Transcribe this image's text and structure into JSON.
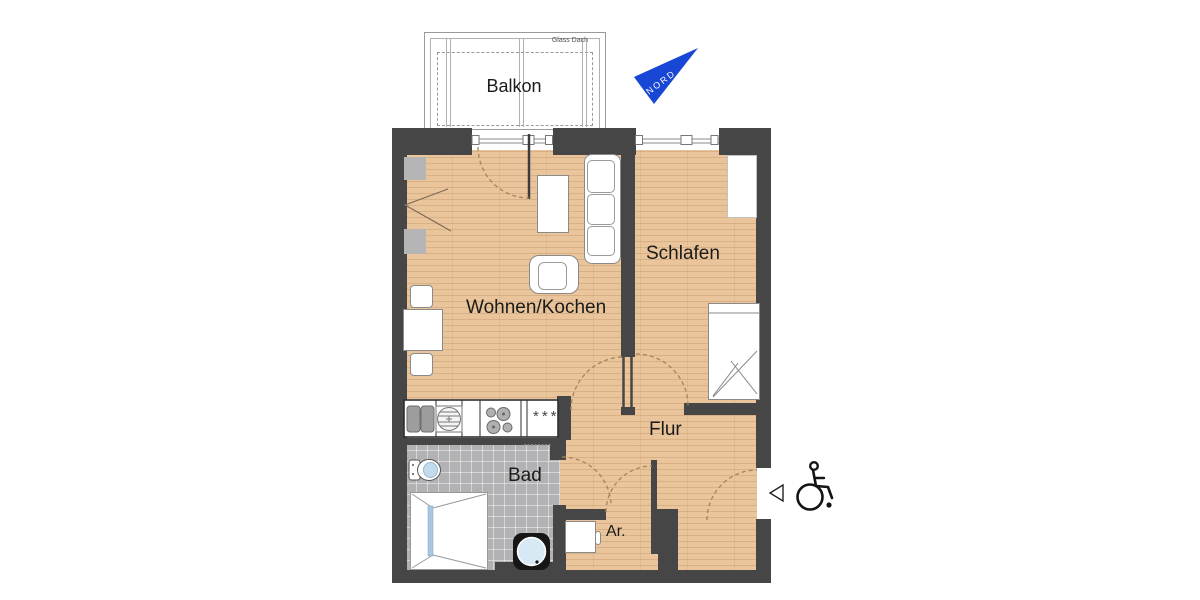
{
  "balcony": {
    "label": "Balkon",
    "roof_note": "Glass Dach"
  },
  "compass": {
    "label": "NORD"
  },
  "rooms": [
    {
      "id": "wohnen-kochen",
      "label": "Wohnen/Kochen"
    },
    {
      "id": "schlafen",
      "label": "Schlafen"
    },
    {
      "id": "flur",
      "label": "Flur"
    },
    {
      "id": "bad",
      "label": "Bad"
    },
    {
      "id": "abstellraum",
      "label": "Ar."
    }
  ],
  "kitchen": {
    "freezer_symbol": "***"
  },
  "icons": {
    "north_arrow": "blue-triangle-compass",
    "wheelchair": "accessibility-symbol",
    "entrance_marker": "left-pointing-triangle"
  },
  "colors": {
    "wall": "#464646",
    "wood_floor": "#eac59b",
    "bath_tile": "#b2b2b4",
    "north_blue": "#1847d6",
    "water_blue": "#c2dcee",
    "shower_glass": "#aac7e2"
  }
}
